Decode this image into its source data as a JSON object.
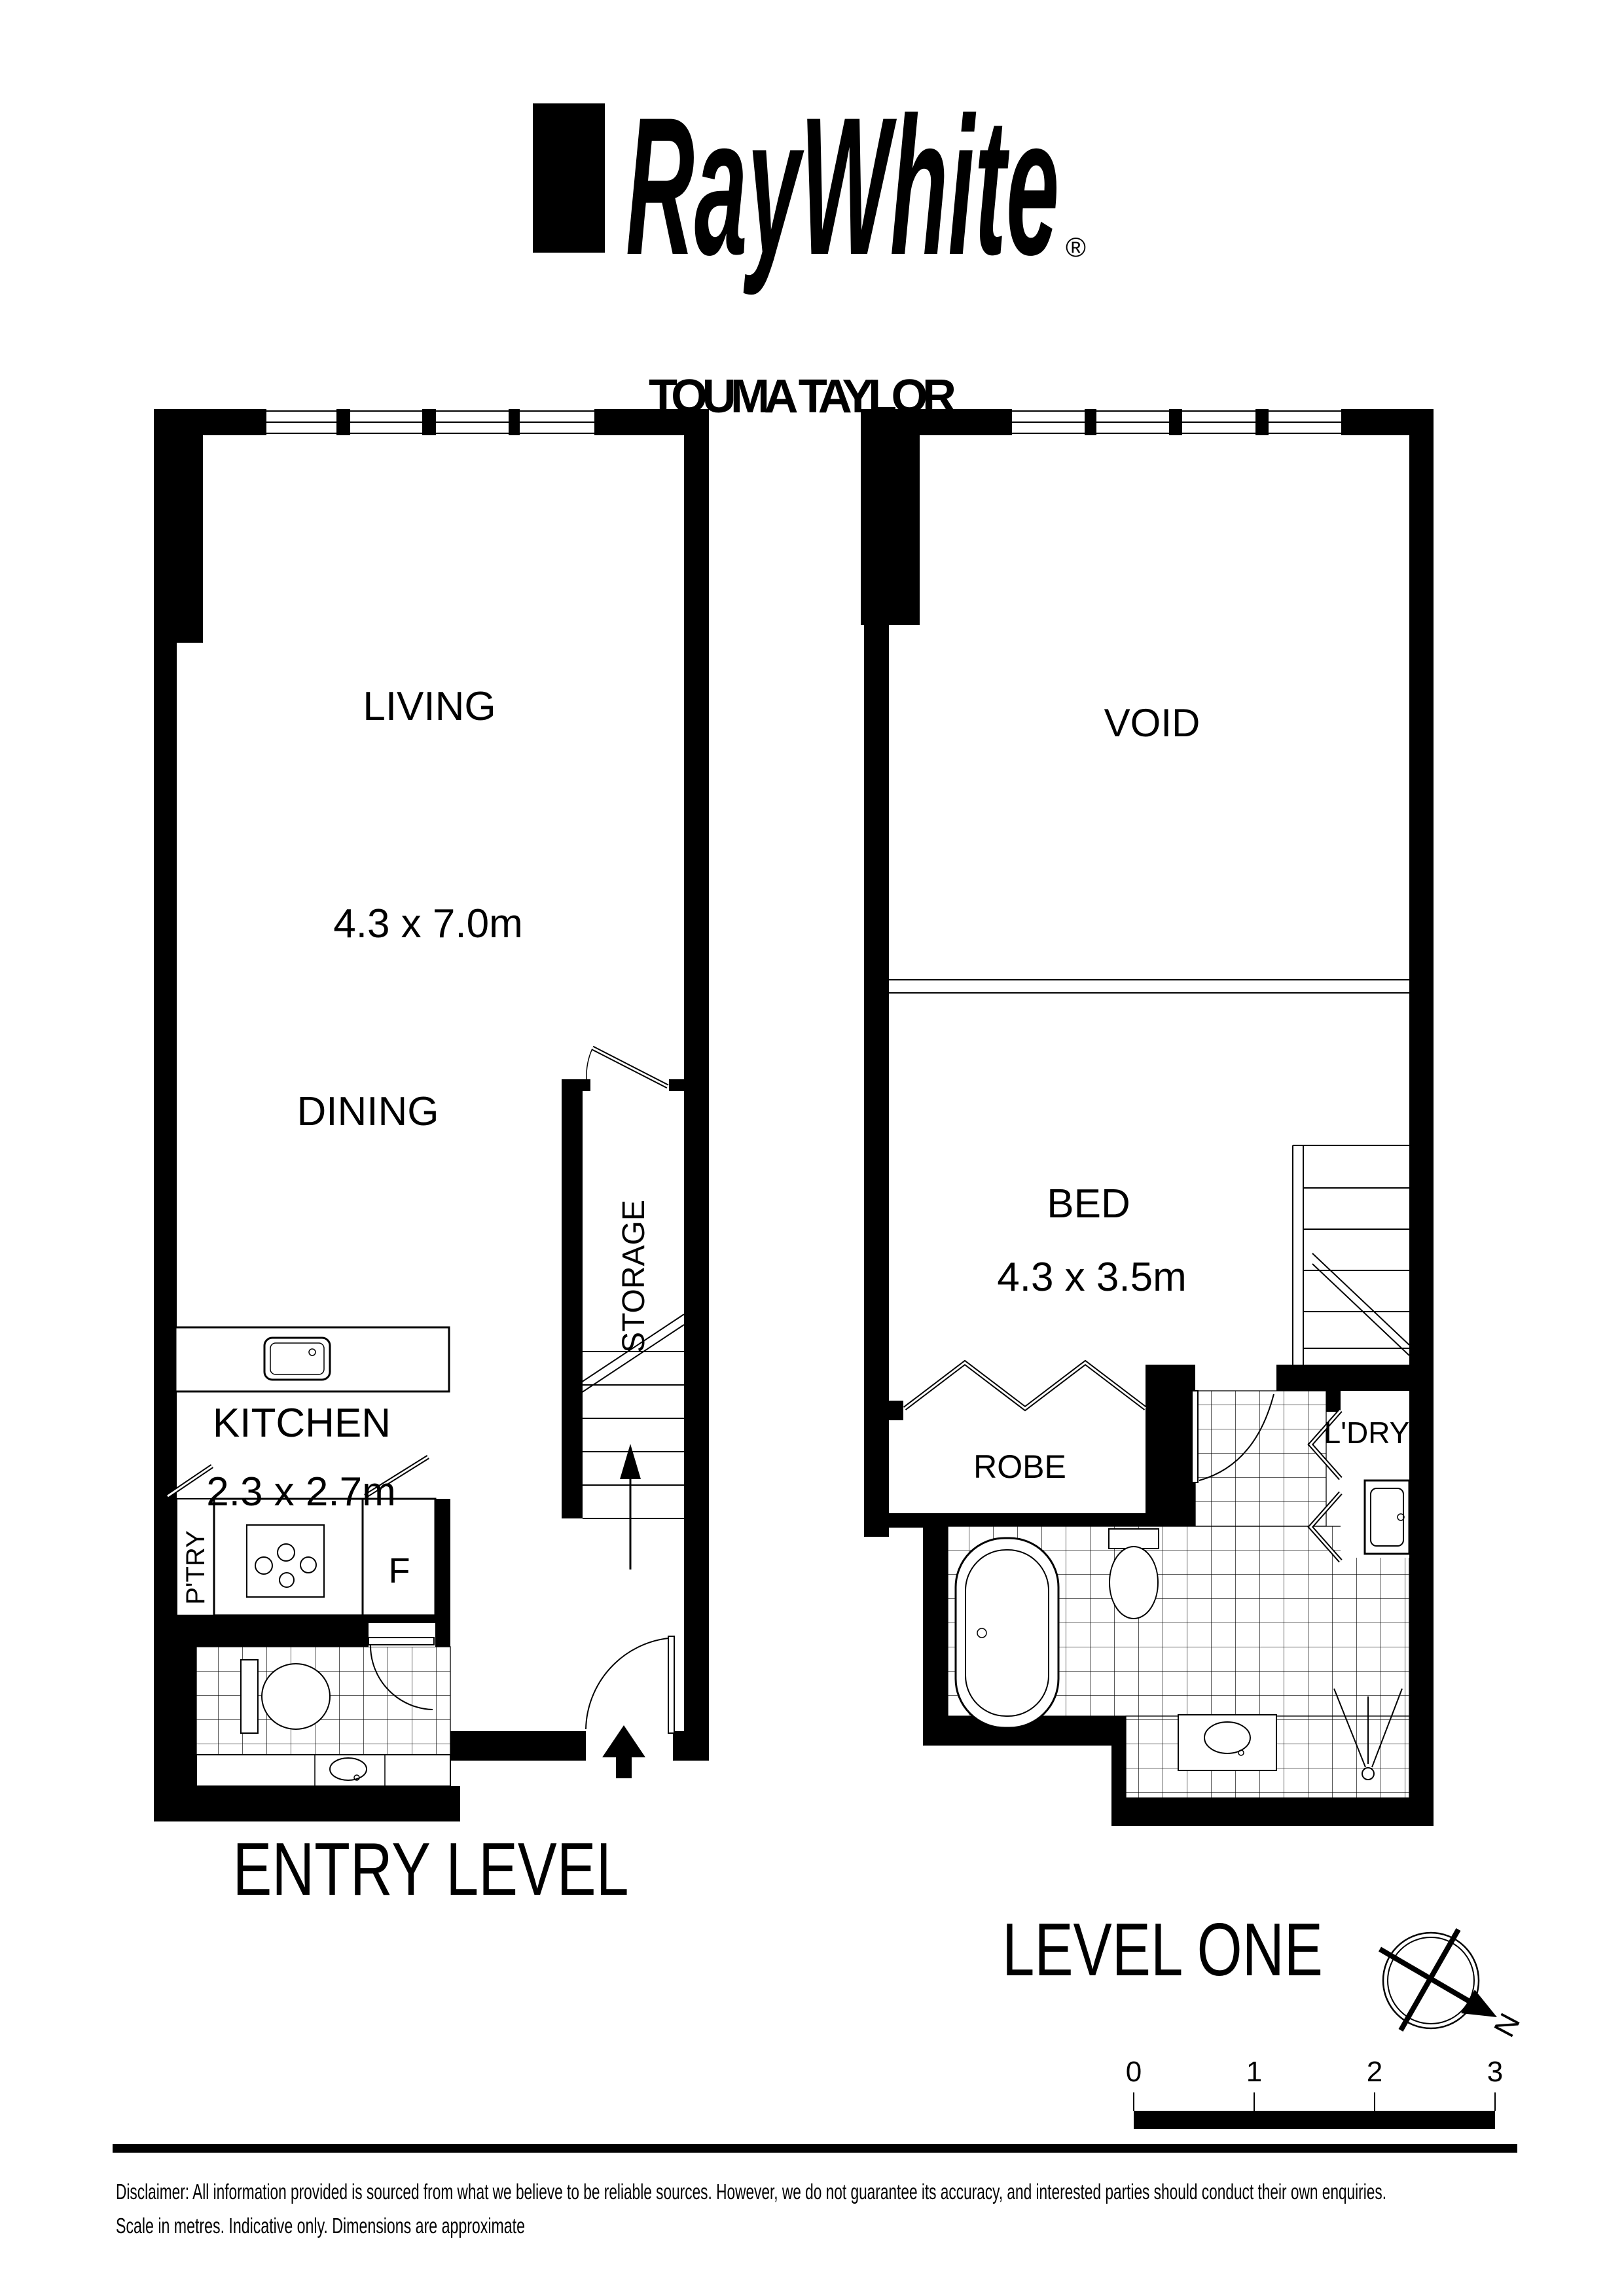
{
  "brand": {
    "logo_text": "RayWhite",
    "registered_mark": "®",
    "agency_name": "TOUMA TAYLOR"
  },
  "floorplans": {
    "entry_level": {
      "title": "ENTRY LEVEL",
      "rooms": {
        "living": {
          "label": "LIVING",
          "dimensions": "4.3 x 7.0m"
        },
        "dining": {
          "label": "DINING"
        },
        "kitchen": {
          "label": "KITCHEN",
          "dimensions": "2.3 x 2.7m"
        },
        "storage": {
          "label": "STORAGE"
        },
        "pantry": {
          "label": "P'TRY"
        },
        "fridge": {
          "label": "F"
        }
      }
    },
    "level_one": {
      "title": "LEVEL ONE",
      "rooms": {
        "void": {
          "label": "VOID"
        },
        "bed": {
          "label": "BED",
          "dimensions": "4.3 x 3.5m"
        },
        "robe": {
          "label": "ROBE"
        },
        "laundry": {
          "label": "L'DRY"
        }
      }
    }
  },
  "compass": {
    "north_label": "N"
  },
  "scale_bar": {
    "ticks": [
      "0",
      "1",
      "2",
      "3"
    ]
  },
  "disclaimer": {
    "line1": "Disclaimer: All information provided is sourced from what we believe to be reliable sources. However, we do not guarantee  its accuracy, and interested parties should conduct their own enquiries.",
    "line2": "Scale in metres. Indicative only. Dimensions are approximate"
  },
  "colors": {
    "ink": "#000000",
    "background": "#ffffff"
  }
}
